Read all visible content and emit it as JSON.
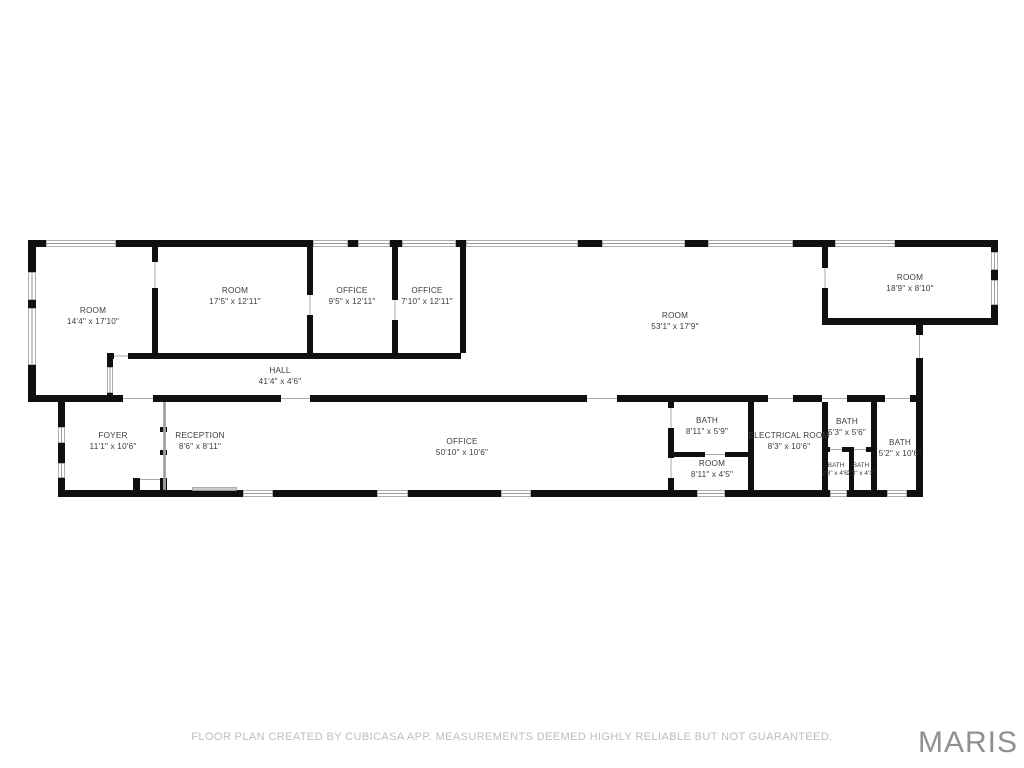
{
  "page": {
    "background": "#ffffff"
  },
  "footer": {
    "disclaimer": "FLOOR PLAN CREATED BY CUBICASA APP. MEASUREMENTS DEEMED HIGHLY RELIABLE BUT NOT GUARANTEED.",
    "logo": "MARIS"
  },
  "floor_plan": {
    "wall_color": "#101010",
    "window_color": "#9a9a9a",
    "door_color": "#aaaaaa",
    "label_color": "#3c3c3c",
    "rooms": [
      {
        "name": "ROOM",
        "dims": "14'4\" x 17'10\"",
        "x": 93,
        "y": 316,
        "small": false
      },
      {
        "name": "ROOM",
        "dims": "17'5\" x 12'11\"",
        "x": 235,
        "y": 296,
        "small": false
      },
      {
        "name": "OFFICE",
        "dims": "9'5\" x 12'11\"",
        "x": 352,
        "y": 296,
        "small": false
      },
      {
        "name": "OFFICE",
        "dims": "7'10\" x 12'11\"",
        "x": 427,
        "y": 296,
        "small": false
      },
      {
        "name": "ROOM",
        "dims": "53'1\" x 17'9\"",
        "x": 675,
        "y": 321,
        "small": false
      },
      {
        "name": "ROOM",
        "dims": "18'9\" x 8'10\"",
        "x": 910,
        "y": 283,
        "small": false
      },
      {
        "name": "HALL",
        "dims": "41'4\" x 4'6\"",
        "x": 280,
        "y": 376,
        "small": false
      },
      {
        "name": "FOYER",
        "dims": "11'1\" x 10'6\"",
        "x": 113,
        "y": 441,
        "small": false
      },
      {
        "name": "RECEPTION",
        "dims": "8'6\" x 8'11\"",
        "x": 200,
        "y": 441,
        "small": false
      },
      {
        "name": "OFFICE",
        "dims": "50'10\" x 10'6\"",
        "x": 462,
        "y": 447,
        "small": false
      },
      {
        "name": "BATH",
        "dims": "8'11\" x 5'9\"",
        "x": 707,
        "y": 426,
        "small": false
      },
      {
        "name": "ROOM",
        "dims": "8'11\" x 4'5\"",
        "x": 712,
        "y": 469,
        "small": false
      },
      {
        "name": "ELECTRICAL ROOM",
        "dims": "8'3\" x 10'6\"",
        "x": 789,
        "y": 441,
        "small": false
      },
      {
        "name": "BATH",
        "dims": "5'3\" x 5'6\"",
        "x": 847,
        "y": 427,
        "small": false
      },
      {
        "name": "BATH",
        "dims": "5'2\" x 10'6\"",
        "x": 900,
        "y": 448,
        "small": false
      },
      {
        "name": "BATH",
        "dims": "2'8\" x 4'6\"",
        "x": 836,
        "y": 470,
        "small": true
      },
      {
        "name": "BATH",
        "dims": "2'3\" x 4'1\"",
        "x": 861,
        "y": 470,
        "small": true
      }
    ],
    "walls": [
      [
        28,
        240,
        18,
        7
      ],
      [
        116,
        240,
        197,
        7
      ],
      [
        348,
        240,
        10,
        7
      ],
      [
        390,
        240,
        12,
        7
      ],
      [
        456,
        240,
        10,
        7
      ],
      [
        578,
        240,
        24,
        7
      ],
      [
        685,
        240,
        23,
        7
      ],
      [
        793,
        240,
        42,
        7
      ],
      [
        895,
        240,
        103,
        7
      ],
      [
        28,
        247,
        8,
        25
      ],
      [
        28,
        300,
        8,
        8
      ],
      [
        28,
        365,
        8,
        37
      ],
      [
        152,
        247,
        6,
        15
      ],
      [
        152,
        288,
        6,
        65
      ],
      [
        307,
        247,
        6,
        48
      ],
      [
        307,
        315,
        6,
        38
      ],
      [
        392,
        247,
        6,
        53
      ],
      [
        392,
        320,
        6,
        33
      ],
      [
        460,
        247,
        6,
        106
      ],
      [
        107,
        353,
        7,
        6
      ],
      [
        128,
        353,
        333,
        6
      ],
      [
        107,
        359,
        6,
        8
      ],
      [
        107,
        393,
        6,
        9
      ],
      [
        28,
        395,
        95,
        7
      ],
      [
        153,
        395,
        128,
        7
      ],
      [
        310,
        395,
        277,
        7
      ],
      [
        617,
        395,
        151,
        7
      ],
      [
        793,
        395,
        29,
        7
      ],
      [
        847,
        395,
        38,
        7
      ],
      [
        910,
        395,
        13,
        7
      ],
      [
        916,
        325,
        7,
        10
      ],
      [
        916,
        358,
        7,
        139
      ],
      [
        822,
        247,
        6,
        21
      ],
      [
        822,
        288,
        6,
        30
      ],
      [
        822,
        318,
        176,
        7
      ],
      [
        991,
        240,
        7,
        12
      ],
      [
        991,
        270,
        7,
        10
      ],
      [
        991,
        305,
        7,
        20
      ],
      [
        58,
        402,
        7,
        25
      ],
      [
        58,
        443,
        7,
        20
      ],
      [
        58,
        478,
        7,
        19
      ],
      [
        58,
        490,
        75,
        7
      ],
      [
        133,
        490,
        110,
        7
      ],
      [
        273,
        490,
        104,
        7
      ],
      [
        408,
        490,
        93,
        7
      ],
      [
        531,
        490,
        166,
        7
      ],
      [
        725,
        490,
        105,
        7
      ],
      [
        847,
        490,
        40,
        7
      ],
      [
        907,
        490,
        16,
        7
      ],
      [
        133,
        478,
        7,
        12
      ],
      [
        160,
        478,
        7,
        12
      ],
      [
        160,
        427,
        7,
        5
      ],
      [
        160,
        450,
        7,
        5
      ],
      [
        668,
        402,
        6,
        6
      ],
      [
        668,
        428,
        6,
        30
      ],
      [
        668,
        478,
        6,
        19
      ],
      [
        668,
        452,
        37,
        5
      ],
      [
        725,
        452,
        27,
        5
      ],
      [
        748,
        395,
        6,
        102
      ],
      [
        822,
        402,
        6,
        95
      ],
      [
        822,
        447,
        8,
        5
      ],
      [
        842,
        447,
        12,
        5
      ],
      [
        866,
        447,
        10,
        5
      ],
      [
        849,
        452,
        5,
        45
      ],
      [
        871,
        395,
        6,
        102
      ]
    ],
    "windows": [
      [
        46,
        240,
        70,
        7
      ],
      [
        313,
        240,
        35,
        7
      ],
      [
        358,
        240,
        32,
        7
      ],
      [
        402,
        240,
        54,
        7
      ],
      [
        466,
        240,
        112,
        7
      ],
      [
        602,
        240,
        83,
        7
      ],
      [
        708,
        240,
        85,
        7
      ],
      [
        835,
        240,
        60,
        7
      ],
      [
        28,
        272,
        8,
        28
      ],
      [
        28,
        308,
        8,
        57
      ],
      [
        107,
        367,
        6,
        26
      ],
      [
        991,
        252,
        7,
        18
      ],
      [
        991,
        280,
        7,
        25
      ],
      [
        58,
        427,
        7,
        16
      ],
      [
        58,
        463,
        7,
        15
      ],
      [
        243,
        490,
        30,
        7
      ],
      [
        377,
        490,
        31,
        7
      ],
      [
        501,
        490,
        30,
        7
      ],
      [
        697,
        490,
        28,
        7
      ],
      [
        830,
        490,
        17,
        7
      ],
      [
        887,
        490,
        20,
        7
      ],
      [
        192,
        487,
        45,
        4
      ],
      [
        163,
        402,
        3,
        88
      ]
    ],
    "doors": [
      [
        123,
        395,
        30,
        7
      ],
      [
        281,
        395,
        29,
        7
      ],
      [
        587,
        395,
        30,
        7
      ],
      [
        768,
        395,
        25,
        7
      ],
      [
        822,
        395,
        25,
        7
      ],
      [
        885,
        395,
        25,
        7
      ],
      [
        916,
        335,
        7,
        23
      ],
      [
        822,
        268,
        6,
        20
      ],
      [
        152,
        262,
        6,
        26
      ],
      [
        307,
        295,
        6,
        20
      ],
      [
        392,
        300,
        6,
        20
      ],
      [
        114,
        353,
        14,
        6
      ],
      [
        668,
        408,
        6,
        20
      ],
      [
        668,
        458,
        6,
        20
      ],
      [
        705,
        452,
        20,
        5
      ],
      [
        830,
        447,
        12,
        5
      ],
      [
        854,
        447,
        12,
        5
      ],
      [
        140,
        477,
        20,
        5
      ]
    ]
  }
}
